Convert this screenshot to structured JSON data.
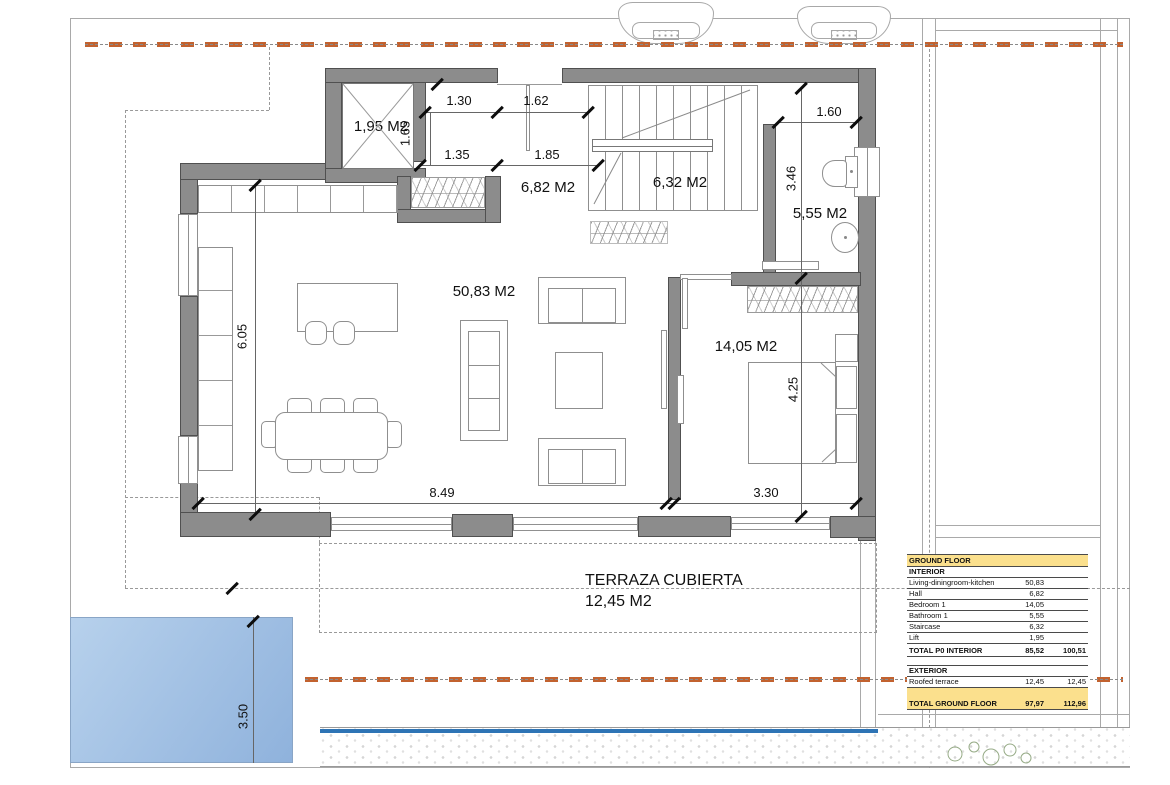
{
  "rooms": {
    "lift": "1,95 M2",
    "hall": "6,82 M2",
    "staircase": "6,32 M2",
    "bathroom": "5,55 M2",
    "living": "50,83 M2",
    "bedroom": "14,05 M2"
  },
  "terrace": {
    "name": "TERRAZA CUBIERTA",
    "area": "12,45 M2"
  },
  "dimensions": {
    "hall_w1": "1.30",
    "hall_w2": "1.62",
    "hall_h": "1.65",
    "closet_w": "1.35",
    "hall_w3": "1.85",
    "bath_door": "1.60",
    "bath_depth": "3.46",
    "kitchen_depth": "6.05",
    "bedroom_depth": "4.25",
    "living_width": "8.49",
    "bedroom_width": "3.30",
    "pool_width": "3.50"
  },
  "area_table": {
    "title": "GROUND FLOOR",
    "interior_header": "INTERIOR",
    "interior_rows": [
      {
        "label": "Living-diningroom-kitchen",
        "v1": "50,83",
        "v2": ""
      },
      {
        "label": "Hall",
        "v1": "6,82",
        "v2": ""
      },
      {
        "label": "Bedroom 1",
        "v1": "14,05",
        "v2": ""
      },
      {
        "label": "Bathroom 1",
        "v1": "5,55",
        "v2": ""
      },
      {
        "label": "Staircase",
        "v1": "6,32",
        "v2": ""
      },
      {
        "label": "Lift",
        "v1": "1,95",
        "v2": ""
      }
    ],
    "interior_total": {
      "label": "TOTAL P0 INTERIOR",
      "v1": "85,52",
      "v2": "100,51"
    },
    "exterior_header": "EXTERIOR",
    "exterior_rows": [
      {
        "label": "Roofed terrace",
        "v1": "12,45",
        "v2": "12,45"
      }
    ],
    "total": {
      "label": "TOTAL GROUND FLOOR",
      "v1": "97,97",
      "v2": "112,96"
    }
  },
  "colors": {
    "wall": "#8c8c8c",
    "boundary_orange": "#c2622f",
    "pool_light": "#b7d1ec",
    "pool_dark": "#8fb2dc",
    "water_edge": "#2e74b5",
    "table_highlight": "#fbe08d",
    "plant_green": "#96ab86"
  }
}
